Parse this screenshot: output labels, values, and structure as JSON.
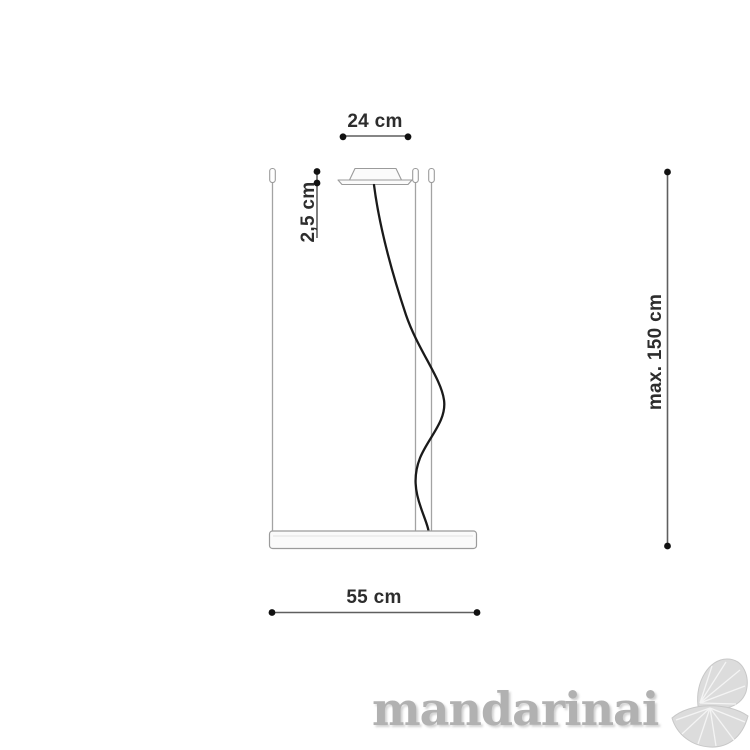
{
  "dimensions": {
    "canopy_width": "24 cm",
    "canopy_height": "2,5 cm",
    "max_drop": "max. 150 cm",
    "fixture_width": "55 cm"
  },
  "watermark": {
    "text": "mandarinai",
    "logo_icon": "mandarin-slices-icon"
  },
  "colors": {
    "dimension_line": "#5f5f5f",
    "dimension_dot": "#111111",
    "label_text": "#2d2d2d",
    "fixture_outline": "#9b9b9b",
    "fixture_fill": "#fafafa",
    "suspension_wire": "#a3a3a3",
    "power_cable": "#1a1a1a",
    "watermark_gray": "#b1b1b1",
    "background": "#ffffff"
  }
}
